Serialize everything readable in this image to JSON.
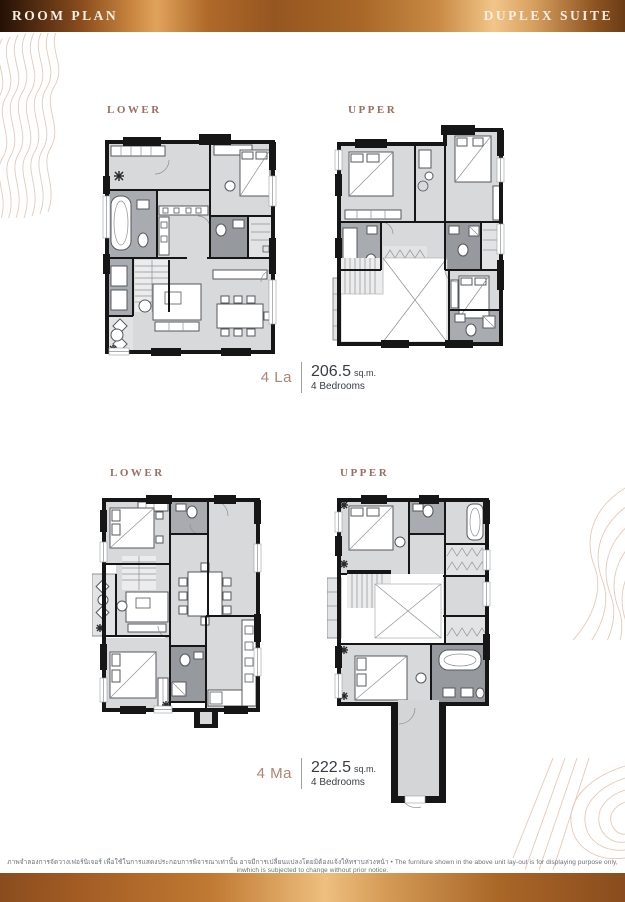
{
  "header": {
    "left_title": "ROOM PLAN",
    "right_title": "DUPLEX SUITE"
  },
  "units": [
    {
      "code": "4 La",
      "area": "206.5",
      "area_unit": "sq.m.",
      "bedrooms": "4 Bedrooms",
      "plans": [
        {
          "label": "LOWER"
        },
        {
          "label": "UPPER"
        }
      ]
    },
    {
      "code": "4 Ma",
      "area": "222.5",
      "area_unit": "sq.m.",
      "bedrooms": "4 Bedrooms",
      "plans": [
        {
          "label": "LOWER"
        },
        {
          "label": "UPPER"
        }
      ]
    }
  ],
  "footer": {
    "disclaimer_th": "ภาพจำลองการจัดวางเฟอร์นิเจอร์ เพื่อใช้ในการแสดงประกอบการพิจารณาเท่านั้น อาจมีการเปลี่ยนแปลงโดยมิต้องแจ้งให้ทราบล่วงหน้า",
    "bullet": "•",
    "disclaimer_en": "The furniture shown in the above unit lay-out is for displaying purpose only, inwhich is subjected to change without prior notice."
  },
  "colors": {
    "accent_copper": "#b08370",
    "floor_label": "#9a6f60",
    "wall": "#161616",
    "room_light": "#d7d9db",
    "room_bath": "#a8abaf"
  }
}
